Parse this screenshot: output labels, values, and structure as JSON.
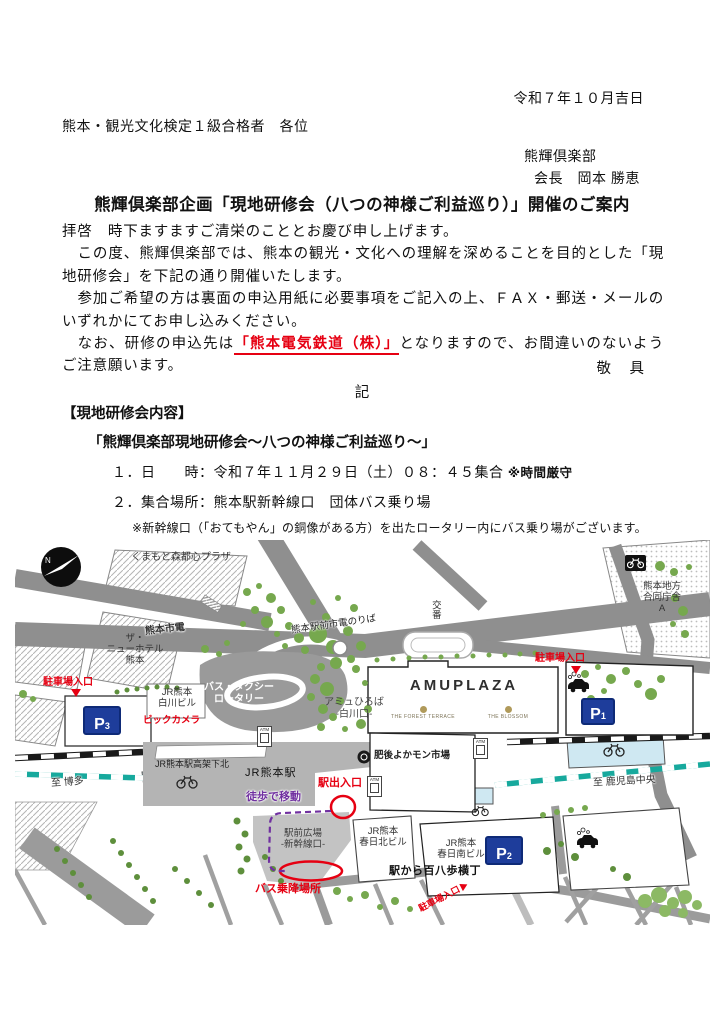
{
  "letter": {
    "date": "令和７年１０月吉日",
    "recipient": "熊本・観光文化検定１級合格者　各位",
    "sender_org": "熊輝倶楽部",
    "sender_person": "会長　岡本 勝恵",
    "title": "熊輝倶楽部企画「現地研修会（八つの神様ご利益巡り）」開催のご案内",
    "para1": "拝啓　時下ますますご清栄のこととお慶び申し上げます。",
    "para2": "　この度、熊輝倶楽部では、熊本の観光・文化への理解を深めることを目的とした「現地研修会」を下記の通り開催いたします。",
    "para3": "　参加ご希望の方は裏面の申込用紙に必要事項をご記入の上、ＦＡＸ・郵送・メールのいずれかにてお申し込みください。",
    "para4_prefix": "　なお、研修の申込先は",
    "para4_highlight": "「熊本電気鉄道（株）」",
    "para4_suffix": "となりますので、お間違いのないようご注意願います。",
    "keigu": "敬　具",
    "ki": "記",
    "section_heading": "【現地研修会内容】",
    "subtitle": "「熊輝倶楽部現地研修会～八つの神様ご利益巡り～」",
    "item1_label": "１．日　　時：",
    "item1_value": "令和７年１１月２９日（土）０８：４５集合",
    "item1_note": "※時間厳守",
    "item2_label": "２．集合場所：",
    "item2_value": "熊本駅新幹線口　団体バス乗り場",
    "note": "※新幹線口（「おてもやん」の銅像がある方）を出たロータリー内にバス乗り場がございます。"
  },
  "map": {
    "compass": "N",
    "labels": {
      "moritoshin_plaza": "くまもと森都心プラザ",
      "shiden": "熊本市電",
      "shiden_noriba": "熊本駅前市電のりば",
      "koban": "交番",
      "gov1": "熊本地方",
      "gov2": "合同庁舎",
      "gov3": "A",
      "hotel1": "ザ・",
      "hotel2": "ニューホテル",
      "hotel3": "熊本",
      "parking_entrance_left": "駐車場入口",
      "parking_entrance_right": "駐車場入口",
      "parking_entrance_bottom": "駐車場入口",
      "shirakawa1": "JR熊本",
      "shirakawa2": "白川ビル",
      "bic_camera": "ビックカメラ",
      "rotary1": "バス・タクシー",
      "rotary2": "ロータリー",
      "amu_hiroba1": "アミュひろば",
      "amu_hiroba2": "-白川口-",
      "amuplaza": "AMUPLAZA",
      "forest_terrace": "THE FOREST TERRACE",
      "blossom": "THE BLOSSOM",
      "kokakita": "JR熊本駅高架下北",
      "station": "JR熊本駅",
      "yokamon": "肥後よかモン市場",
      "exit": "駅出入口",
      "walk": "徒歩で移動",
      "to_hakata": "至 博多",
      "to_kagoshima": "至 鹿児島中央",
      "ekimae1": "駅前広場",
      "ekimae2": "-新幹線口-",
      "kasuga_kita1": "JR熊本",
      "kasuga_kita2": "春日北ビル",
      "kasuga_minami1": "JR熊本",
      "kasuga_minami2": "春日南ビル",
      "yokocho": "駅から百八歩横丁",
      "bus_stop": "バス乗降場所",
      "atm": "ATM"
    },
    "parking_signs": {
      "letter": "P",
      "p1": "1",
      "p2": "2",
      "p3": "3"
    },
    "colors": {
      "red": "#e60012",
      "purple": "#7030a0",
      "teal": "#17a99d",
      "parking_blue": "#1e3d9b",
      "road_gray": "#8f8f8f",
      "tree_green": "#76a84e"
    }
  }
}
